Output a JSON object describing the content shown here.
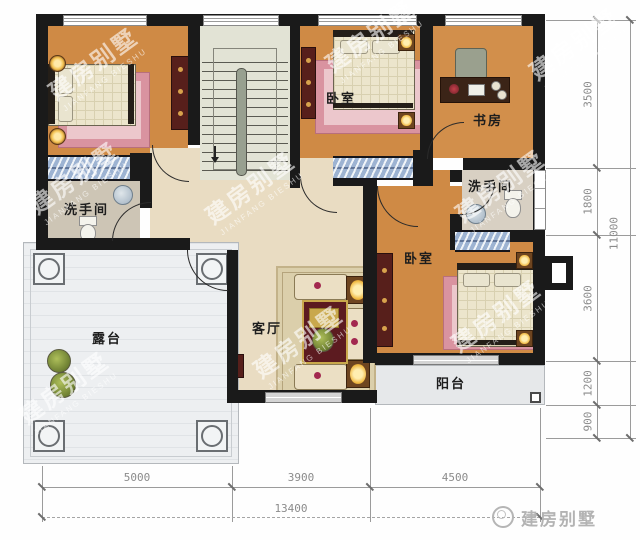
{
  "rooms": {
    "bedroom_top": "卧室",
    "bedroom_right": "卧室",
    "study": "书房",
    "bathroom_left": "洗手间",
    "bathroom_right": "洗手间",
    "living_room": "客厅",
    "balcony": "阳台",
    "terrace": "露台"
  },
  "dimensions": {
    "bottom_segments": [
      "5000",
      "3900",
      "4500"
    ],
    "bottom_total": "13400",
    "right_segments": [
      "3500",
      "1800",
      "3600",
      "1200",
      "900"
    ],
    "right_total": "11000"
  },
  "watermark": {
    "cn": "建房别墅",
    "en": "JIANFANG BIESHU",
    "positions": [
      {
        "x": 95,
        "y": 66
      },
      {
        "x": 372,
        "y": 38
      },
      {
        "x": 576,
        "y": 46
      },
      {
        "x": 76,
        "y": 180
      },
      {
        "x": 252,
        "y": 190
      },
      {
        "x": 502,
        "y": 188
      },
      {
        "x": 300,
        "y": 344
      },
      {
        "x": 498,
        "y": 318
      },
      {
        "x": 66,
        "y": 390
      }
    ]
  },
  "logo": {
    "text": "建房别墅"
  },
  "colors": {
    "wall": "#1a1a1a",
    "bedroom_floor": "#cf8a45",
    "hall_floor": "#e9dcc2",
    "terrace_floor": "#edeff1",
    "rug_pink": "#d993a0",
    "window_blue": "#9db3d2",
    "lamp_gold": "#f3c14f"
  }
}
